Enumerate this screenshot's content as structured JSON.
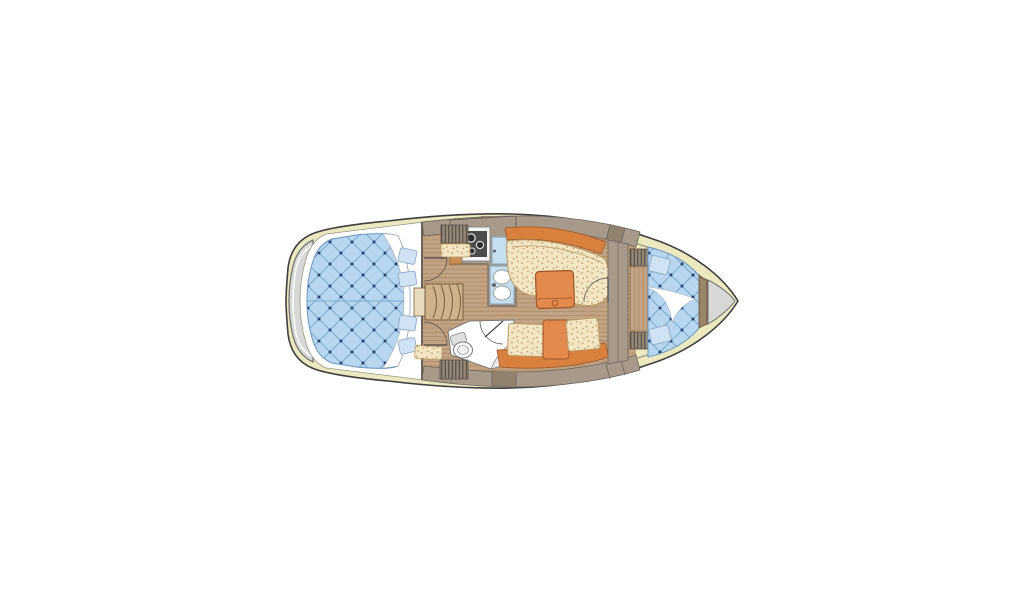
{
  "canvas": {
    "width": 1024,
    "height": 600,
    "background": "#ffffff"
  },
  "features": {
    "vessel": "sailboat-interior-floor-plan",
    "areas": [
      "swim-platform",
      "aft-double-cabin",
      "companionway-steps",
      "galley",
      "saloon",
      "head-toilet",
      "u-shaped-settee",
      "straight-settee",
      "v-berth-cabin",
      "anchor-locker"
    ],
    "fixtures": [
      "stove-3-burners",
      "double-sink",
      "icebox",
      "saloon-table",
      "folding-table",
      "toilet",
      "corner-washbasin",
      "door-swings",
      "quilted-berths",
      "pillows",
      "hatched-lockers"
    ]
  },
  "colors": {
    "background": "#ffffff",
    "outline": "#3f3f3f",
    "deck_cream": "#ece8c0",
    "inner_line": "#8f8c72",
    "platform_gray": "#d8d8d6",
    "platform_stroke": "#6e6e6c",
    "cabin_white": "#ffffff",
    "bed_blue": "#b7d6ef",
    "quilt_line": "#7fa9d2",
    "quilt_dot": "#24416f",
    "bed_stroke": "#6b95bd",
    "pillow_blue": "#cfe3f5",
    "sheet_white": "#ffffff",
    "cushion_cream": "#f3e6c2",
    "speckle_dot": "#b3885a",
    "cushion_stroke": "#b99a66",
    "table_orange": "#e28a4d",
    "table_stroke": "#9c5526",
    "backrest_orange": "#d8813f",
    "wood_base": "#c2a383",
    "wood_line": "#99764f",
    "stairs_tan": "#cdb28b",
    "stairs_stroke": "#7a5c3a",
    "entry_cream": "#e9dcbc",
    "cabinet_taupe": "#a89a8b",
    "cabinet_dark": "#90826f",
    "band_line": "#6b6258",
    "locker_gray": "#958878",
    "hatch_line": "#4e463c",
    "galley_cab_orange": "#c98f55",
    "sink_blue": "#c5dff0",
    "appliance_white": "#f6f6f4",
    "stove_dark": "#4c4c4c",
    "fixture_white": "#ffffff",
    "bulkhead_brown": "#9b8468"
  }
}
